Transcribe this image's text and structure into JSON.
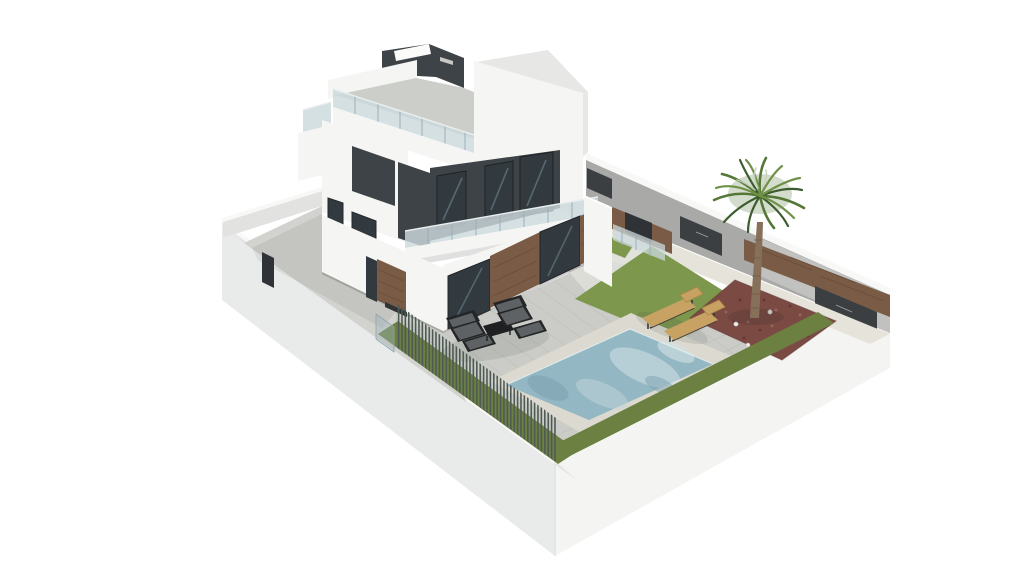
{
  "scene": {
    "type": "3d-architectural-rendering",
    "description": "Aerial isometric 3D rendering of a modern two-storey white villa with dark grey accents, wood-clad sections, glass balustrades and a roof terrace, set on a walled plot with a paved terrace, swimming pool, green lawn strips, a palm tree in a red gravel bed, two wooden sun loungers, a black outdoor lounge set and a slatted metal fence on the front boundary wall.",
    "background": "#ffffff"
  },
  "objects": [
    {
      "name": "villa-house",
      "label": "Modern villa with roof terrace"
    },
    {
      "name": "roof-terrace",
      "label": "Roof terrace with glass balustrade"
    },
    {
      "name": "balcony",
      "label": "First-floor balcony with glass balustrade"
    },
    {
      "name": "swimming-pool",
      "label": "Swimming pool"
    },
    {
      "name": "pool-terrace",
      "label": "Paved pool terrace"
    },
    {
      "name": "lawn",
      "label": "Lawn areas"
    },
    {
      "name": "palm-tree",
      "label": "Palm tree"
    },
    {
      "name": "gravel-bed",
      "label": "Red gravel planting bed with ground lights"
    },
    {
      "name": "sun-loungers",
      "label": "Two wooden sun loungers"
    },
    {
      "name": "lounge-set",
      "label": "Black outdoor lounge set with table"
    },
    {
      "name": "boundary-wall",
      "label": "White boundary walls"
    },
    {
      "name": "metal-fence",
      "label": "Slatted metal fence"
    },
    {
      "name": "driveway-courtyard",
      "label": "Walled driveway courtyard"
    },
    {
      "name": "back-wall-panels",
      "label": "Dark gates in rear wall"
    }
  ],
  "colors": {
    "bg": "#ffffff",
    "wall-outer-left": "#e9ebea",
    "wall-outer-right": "#f4f5f3",
    "wall-inner": "#e2e3e1",
    "coping": "#f8f8f6",
    "courtyard-floor": "#d2d2ce",
    "back-wall": "#a9aaa8",
    "back-wall-light": "#c9c9c7",
    "panel-dark": "#3b3f42",
    "wood": "#7a5b45",
    "wood-dark": "#5f4534",
    "house-white": "#f5f5f3",
    "house-white-shade": "#e7e8e6",
    "charcoal": "#3e4347",
    "charcoal-dark": "#2f3337",
    "glass-dark": "#323a3f",
    "glass-reflect": "#7e98a5",
    "balustrade-glass": "#ccd9dd",
    "balustrade-frame": "#9bafb8",
    "terrace": "#cbccc7",
    "tile-line": "#b9bbb5",
    "path-light": "#dedfd8",
    "gravel-light": "#e6e3da",
    "lawn": "#7d974d",
    "grass-strip": "#6c8042",
    "gravel-red": "#7b4a42",
    "gravel-red-dark": "#5f3733",
    "gravel-red-light": "#96655b",
    "pool-border": "#dbd9d0",
    "pool-water": "#93b7c3",
    "pool-water-light": "#c3d6da",
    "pool-water-dark": "#7da2b1",
    "pool-highlight": "#d3e2e6",
    "fence-slat": "#4e5a54",
    "furniture-black": "#232526",
    "furniture-cushion": "#5f6264",
    "lounger-tan": "#c8a263",
    "lounger-frame": "#3a3a38",
    "palm-trunk": "#87705a",
    "palm-frond": "#547736",
    "palm-frond-dark": "#3c5c2e",
    "palm-frond-light": "#6f9147",
    "deck": "#ccceca",
    "white-detail": "#fbfbfa"
  }
}
